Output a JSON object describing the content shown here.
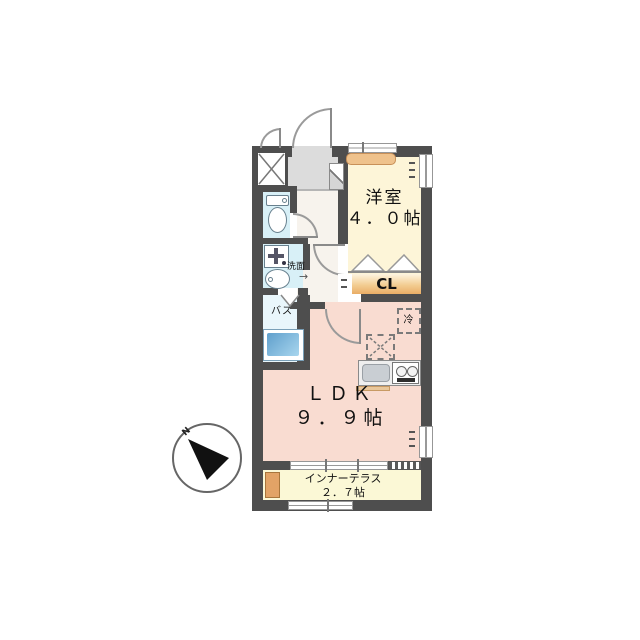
{
  "plan_title": "1LDK floor plan",
  "compass": {
    "north_label": "N"
  },
  "rooms": {
    "western_room": {
      "label": "洋室",
      "size": "４．０帖"
    },
    "closet": {
      "label": "CL"
    },
    "ldk": {
      "label": "ＬＤＫ",
      "size": "９．９帖"
    },
    "inner_terrace": {
      "label": "インナーテラス",
      "size": "２．７帖"
    },
    "bath": {
      "label": "バス"
    },
    "washroom": {
      "label": "洗面"
    },
    "refrigerator": {
      "label": "冷"
    }
  },
  "icons": {
    "entry_arrow": "→"
  },
  "colors": {
    "wall": "#4e4e4e",
    "western_room_floor": "#fdf5d8",
    "ldk_floor": "#f9dcd1",
    "terrace_floor": "#fbf8d6",
    "wet_area_floor": "#d8f0f7",
    "bath_floor": "#e9f6fb",
    "entry_floor": "#dcdcdc",
    "closet_accent": "#eaad66",
    "counter_accent": "#efc28c",
    "tub_blue": "#6fb0d8"
  }
}
